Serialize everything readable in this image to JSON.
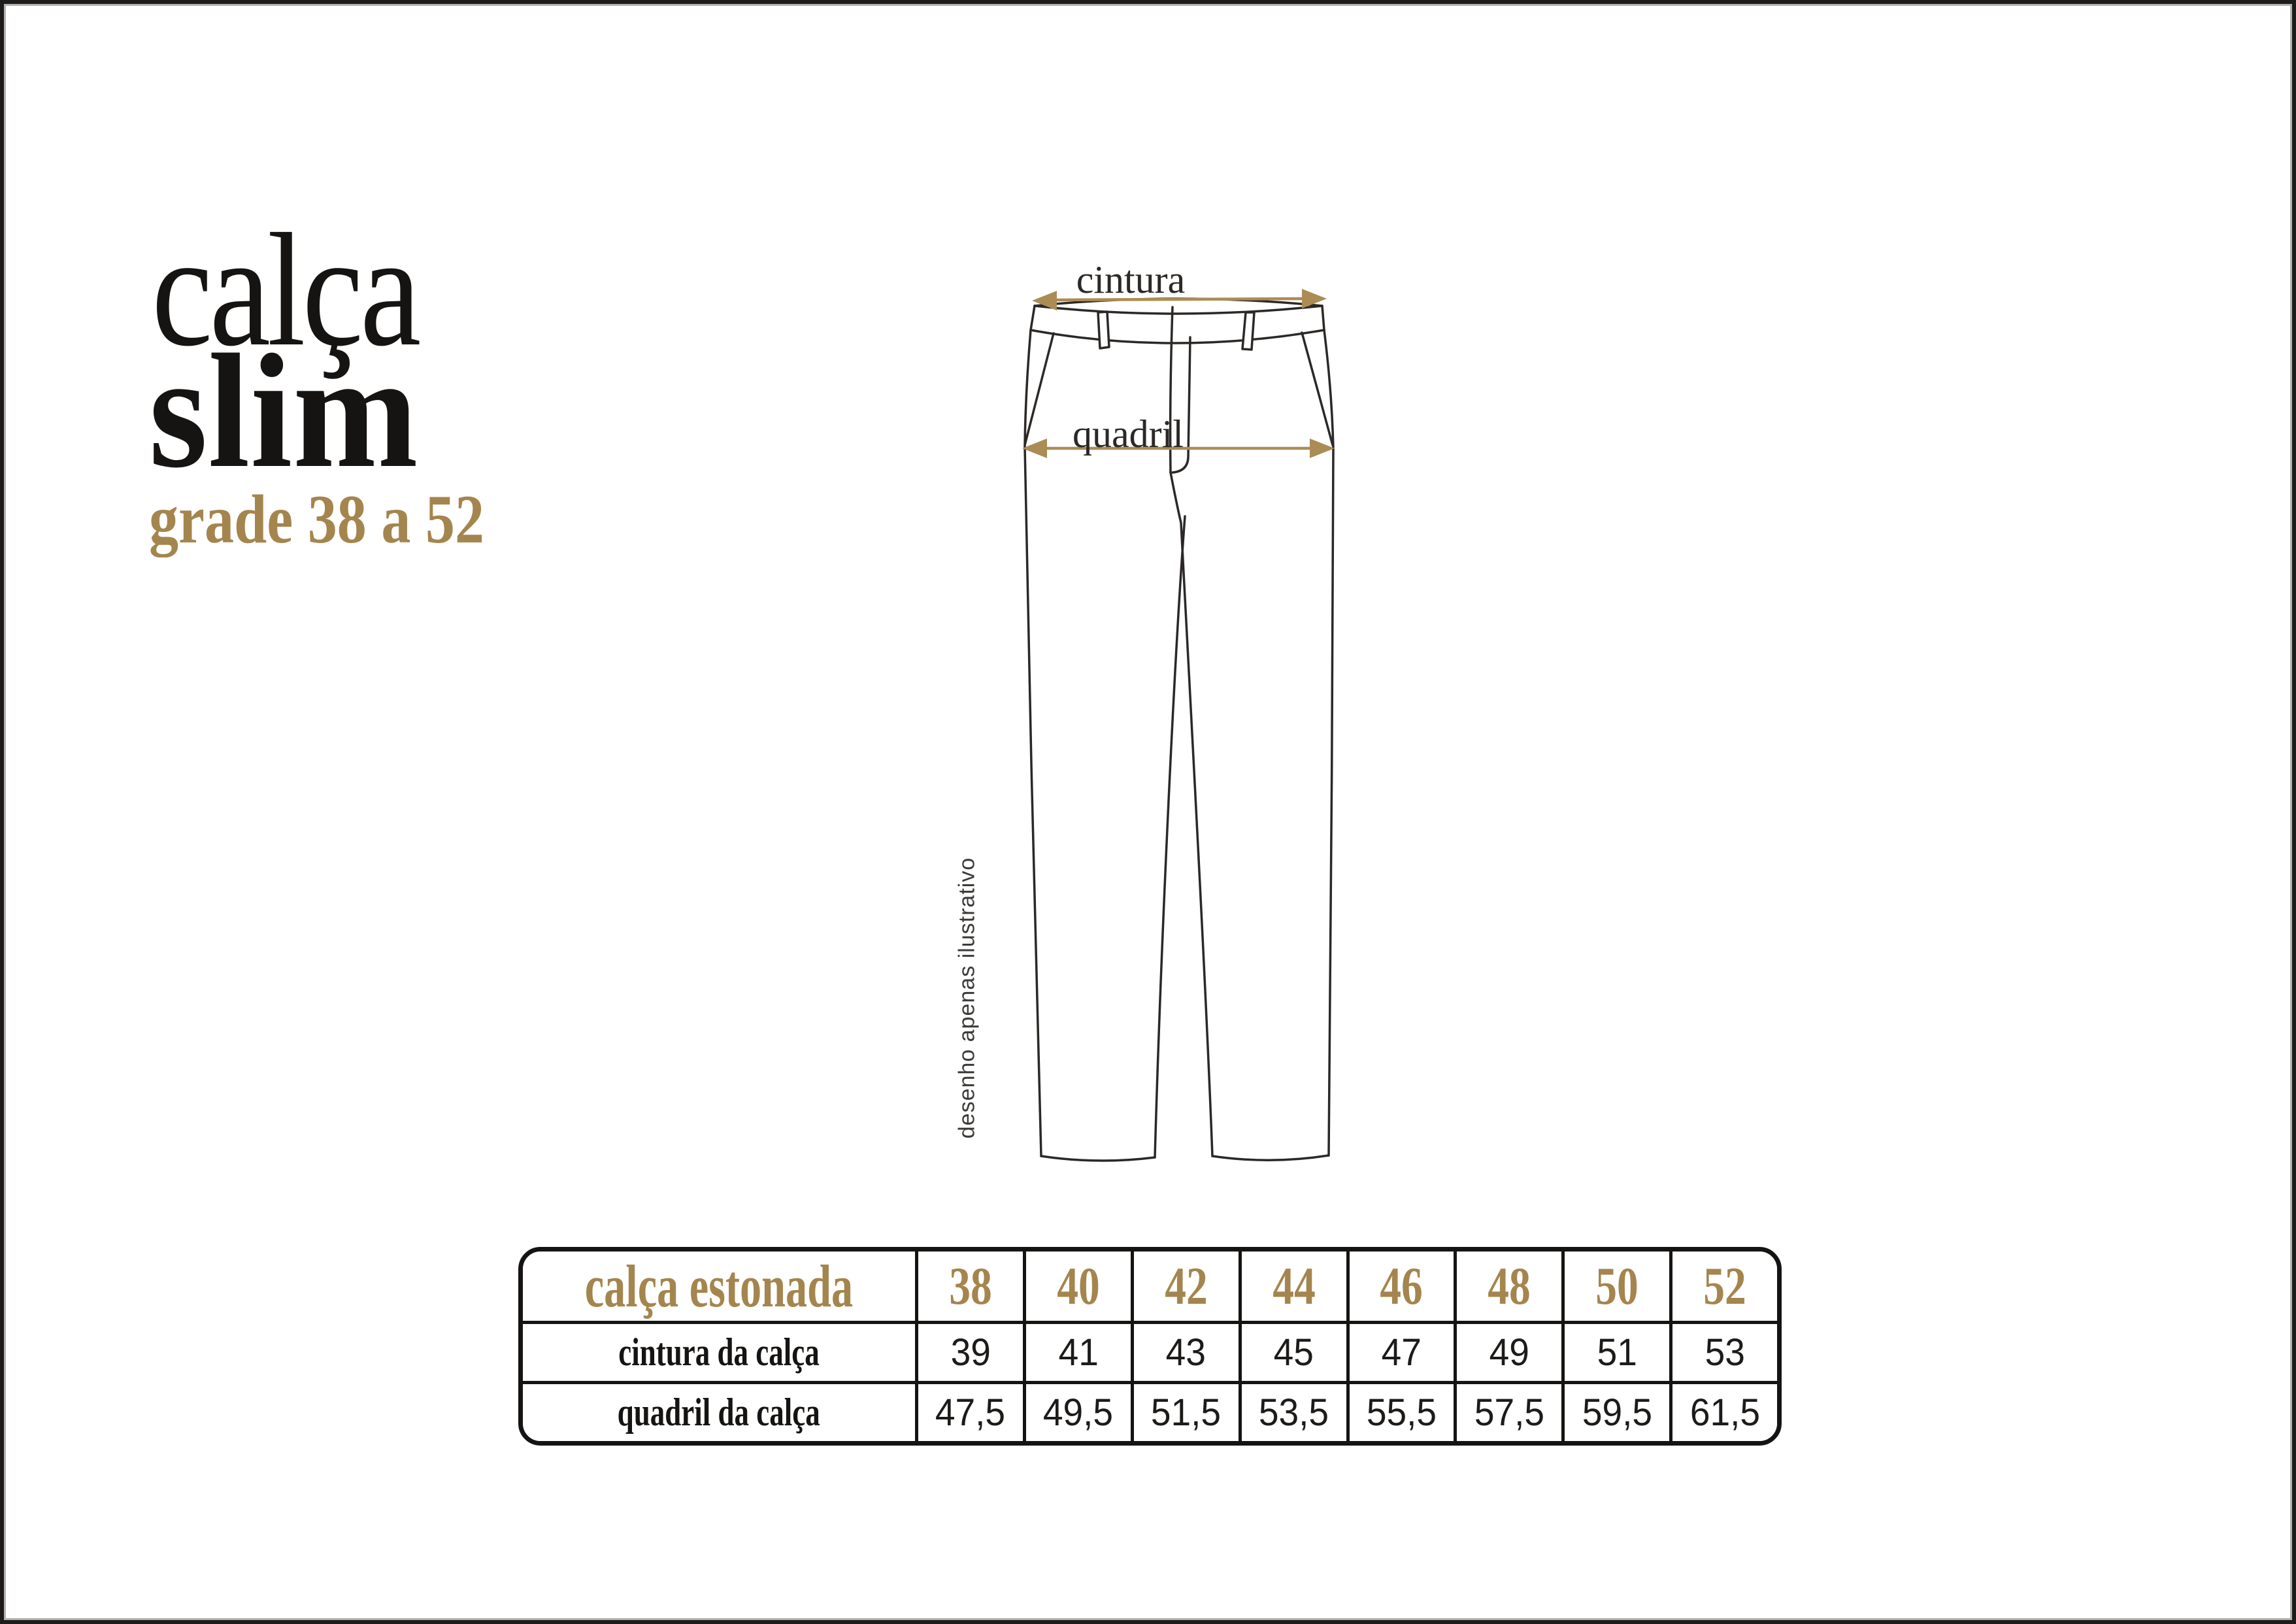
{
  "page": {
    "background": "#ffffff",
    "frame_color": "#1d1c1a"
  },
  "colors": {
    "gold_text": "#a5854e",
    "gold_arrow": "#ab8c55",
    "ink": "#161412",
    "drawing_line": "#2b2826"
  },
  "title": {
    "line1": "calça",
    "line2": "slim",
    "subtitle": "grade 38 a 52"
  },
  "diagram": {
    "waist_label": "cintura",
    "hip_label": "quadril",
    "caption": "desenho apenas ilustrativo"
  },
  "size_table": {
    "header_label": "calça estonada",
    "sizes": [
      "38",
      "40",
      "42",
      "44",
      "46",
      "48",
      "50",
      "52"
    ],
    "rows": [
      {
        "label": "cintura da calça",
        "values": [
          "39",
          "41",
          "43",
          "45",
          "47",
          "49",
          "51",
          "53"
        ]
      },
      {
        "label": "quadril da calça",
        "values": [
          "47,5",
          "49,5",
          "51,5",
          "53,5",
          "55,5",
          "57,5",
          "59,5",
          "61,5"
        ]
      }
    ]
  }
}
